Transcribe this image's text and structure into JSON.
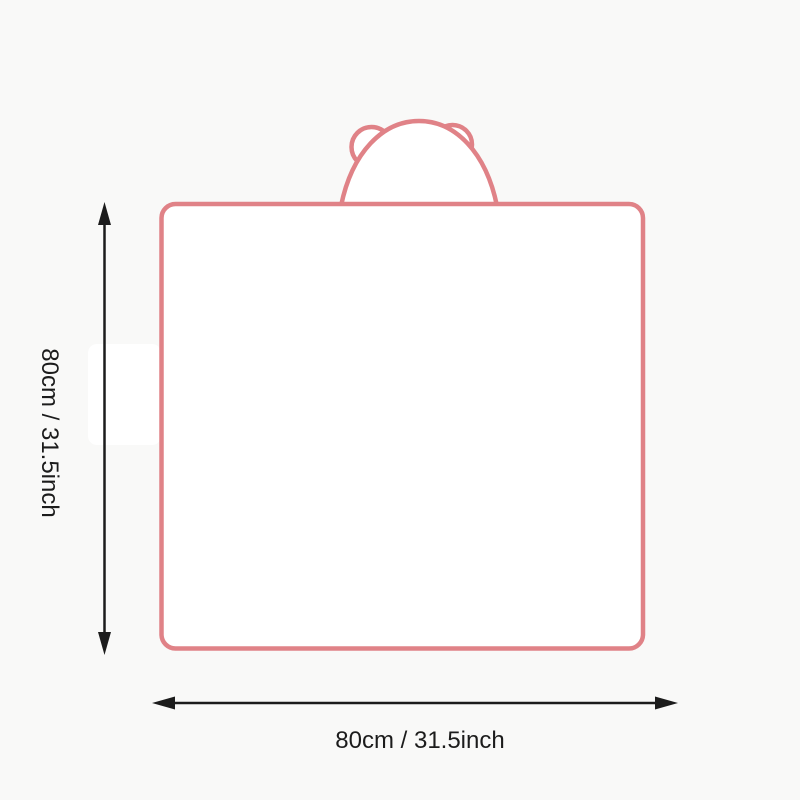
{
  "diagram": {
    "subject": "hooded-blanket-with-bear-ears",
    "height_dimension": {
      "label": "80cm / 31.5inch",
      "orientation": "vertical"
    },
    "width_dimension": {
      "label": "80cm / 31.5inch",
      "orientation": "horizontal"
    },
    "icons": [
      "height-arrow-icon",
      "width-arrow-icon",
      "bear-ear-left-icon",
      "bear-ear-right-icon"
    ]
  },
  "colors": {
    "background": "#f9f9f8",
    "outline": "#e08287",
    "fill": "#ffffff",
    "arrow": "#1c1c1c",
    "text": "#1c1c1c"
  }
}
